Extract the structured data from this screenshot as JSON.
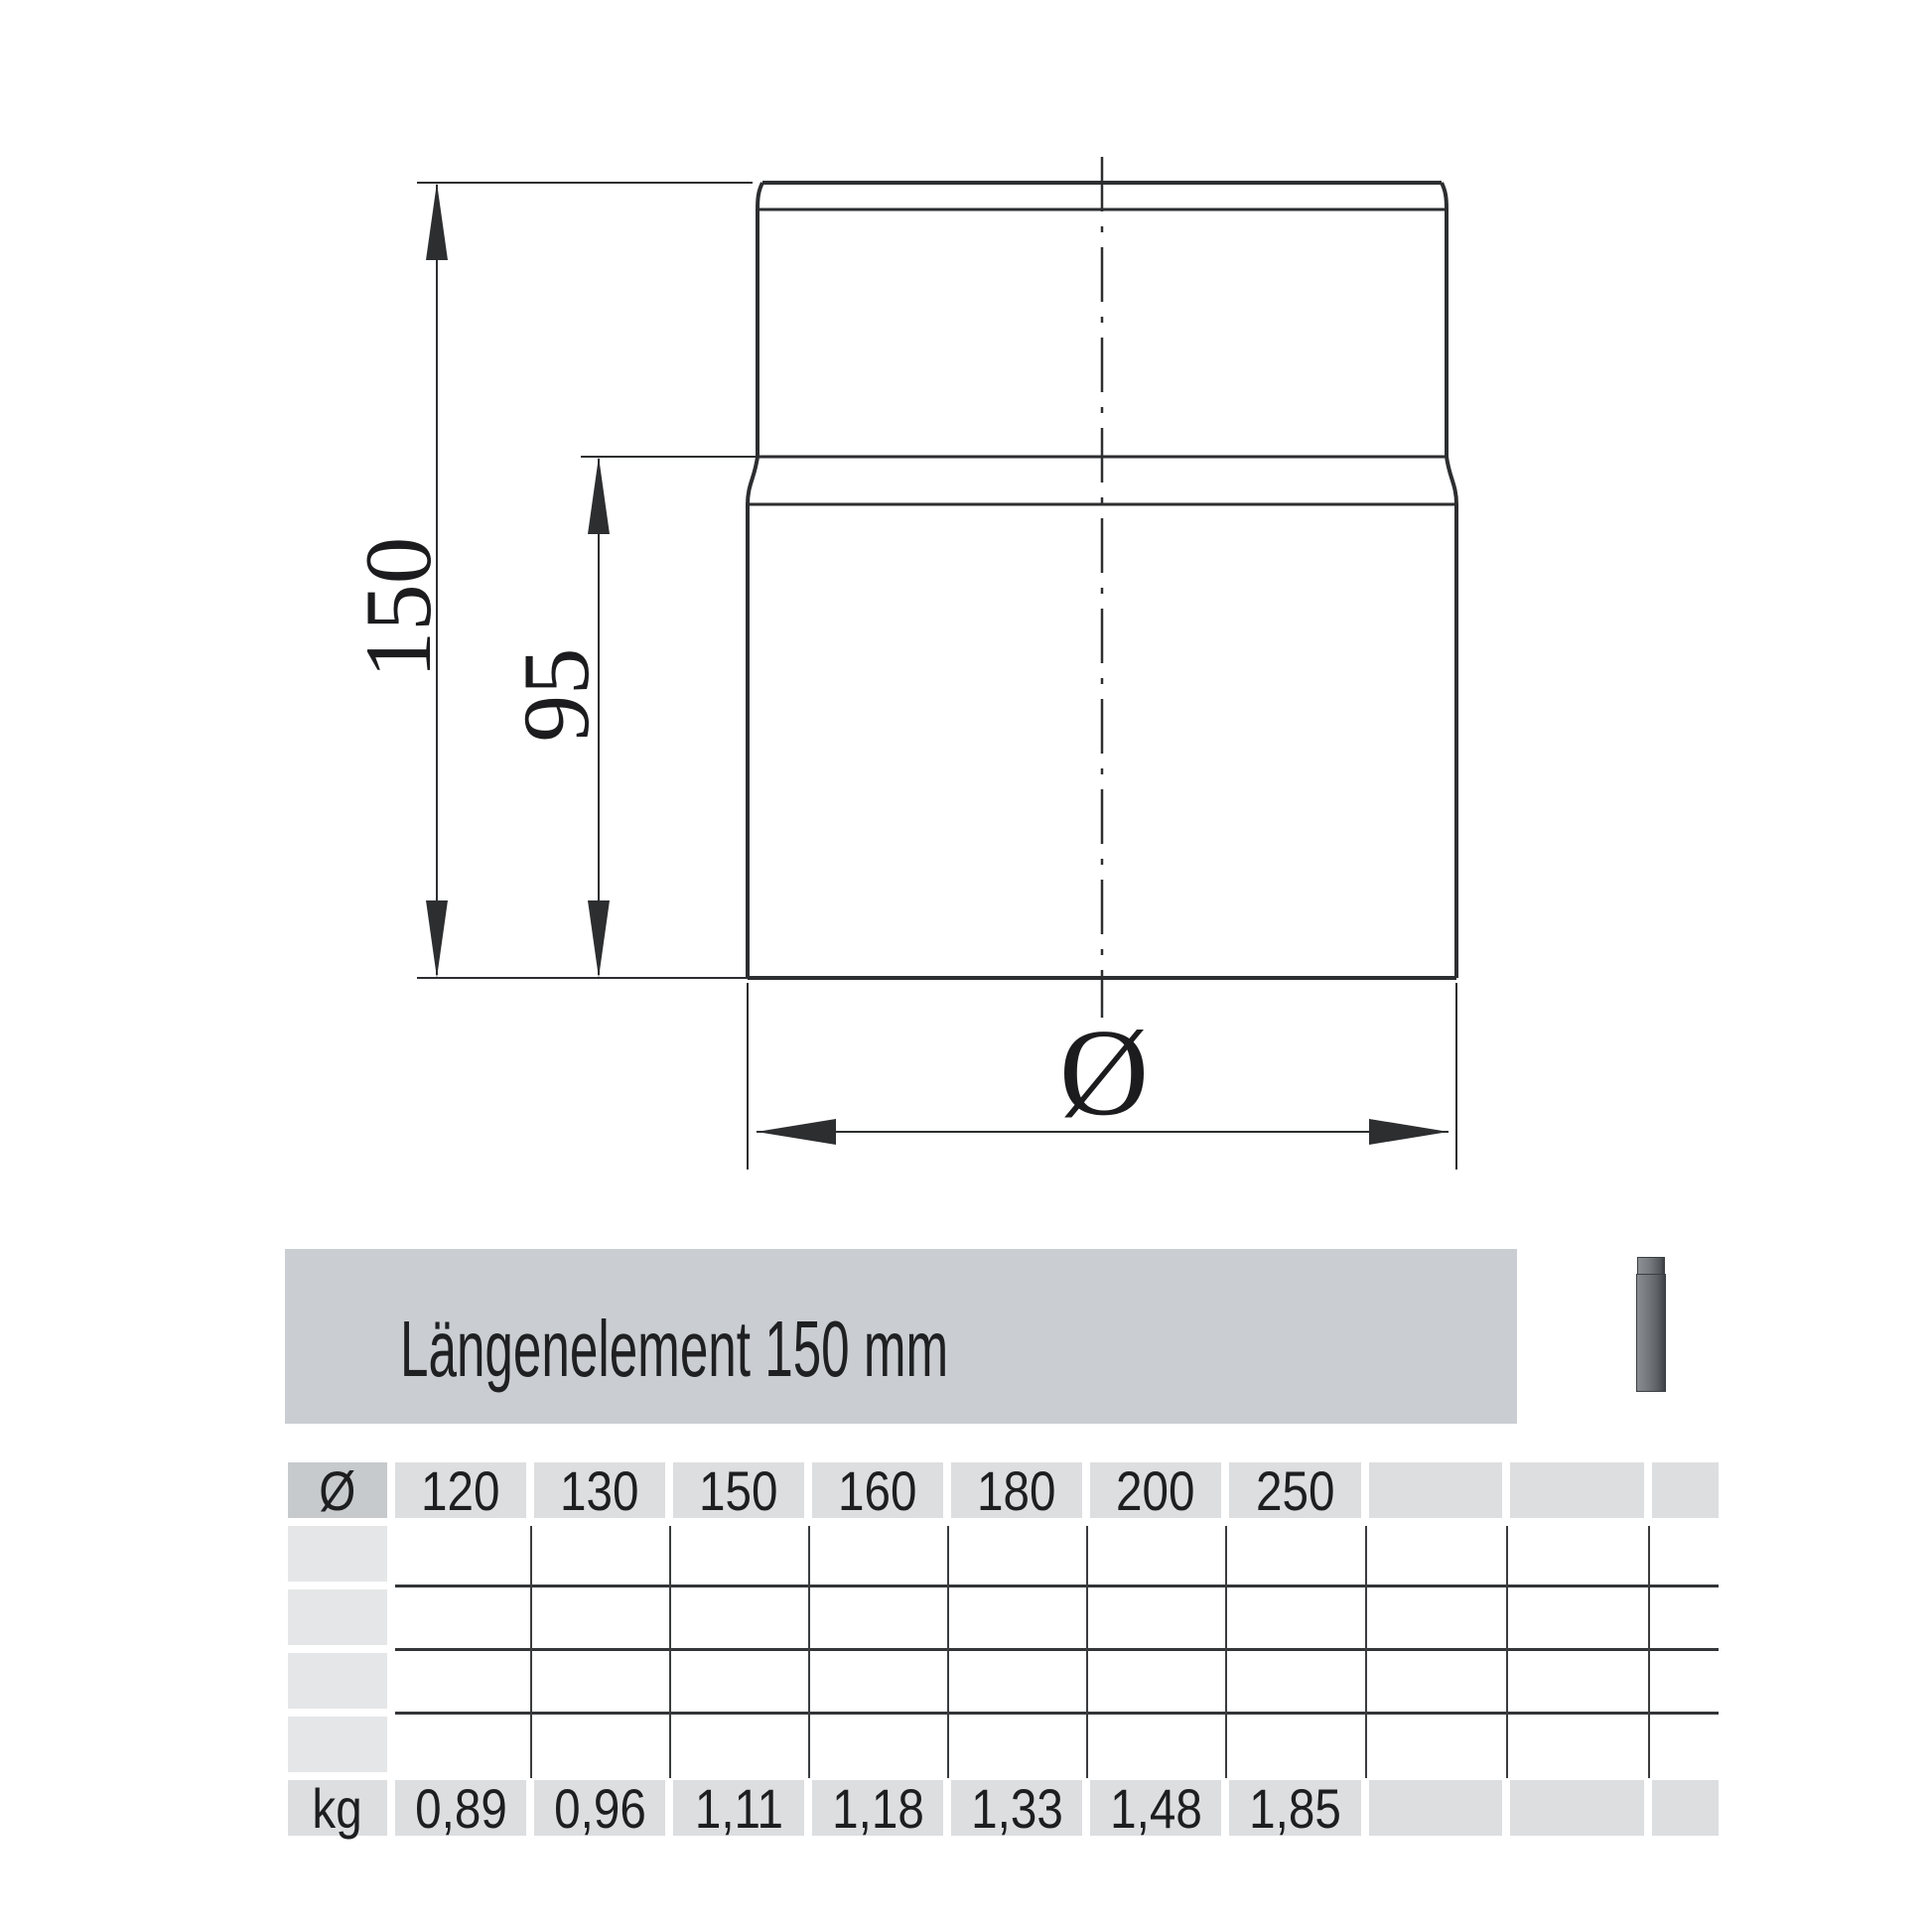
{
  "product": {
    "title": "Längenelement 150 mm"
  },
  "drawing": {
    "dim_total_length": "150",
    "dim_socket_length": "95",
    "diameter_symbol": "Ø"
  },
  "table": {
    "diameter_symbol": "Ø",
    "weight_unit": "kg",
    "diameters": [
      "120",
      "130",
      "150",
      "160",
      "180",
      "200",
      "250"
    ],
    "weights_kg": [
      "0,89",
      "0,96",
      "1,11",
      "1,18",
      "1,33",
      "1,48",
      "1,85"
    ]
  },
  "colors": {
    "title_bar_bg": "#cacdd1",
    "header_cell_bg": "#dcdee0",
    "dark_cell_bg": "#c6cacd",
    "row_label_bg": "#e4e6e7",
    "line_color": "#2d2e30",
    "thumb_dark": "#3e4145",
    "thumb_light": "#898d91"
  }
}
